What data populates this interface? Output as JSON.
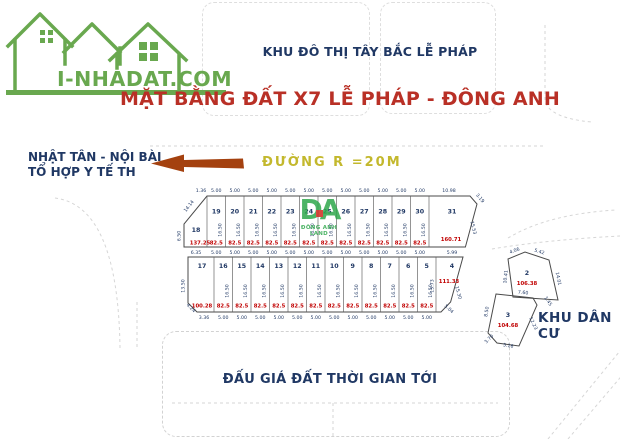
{
  "logo": {
    "text": "I-NHADAT.COM"
  },
  "header": {
    "district": "KHU ĐÔ THỊ TÂY BẮC LỄ PHÁP",
    "title": "MẶT BẰNG ĐẤT X7 LỄ PHÁP - ĐÔNG ANH"
  },
  "annotations": {
    "direction_line1": "NHẬT TÂN - NỘI BÀI",
    "direction_line2": "TỔ HỢP Y TẾ TH",
    "road": "ĐƯỜNG R =20M",
    "residential_area": "KHU DÂN CƯ",
    "auction_note": "ĐẤU GIÁ ĐẤT THỜI GIAN TỚI"
  },
  "watermark": {
    "initials": "DA",
    "name": "ĐÔNG ANH LAND"
  },
  "map": {
    "top_row": {
      "corner_plot": {
        "number": "18",
        "area": "137.25",
        "top_dim": "1.36",
        "left_dim": "6.50",
        "diagonal_dim": "14.14",
        "bottom_dim": "6.35"
      },
      "plots": [
        {
          "number": "19",
          "top_dim": "5.00",
          "height": "16.50",
          "area": "82.5",
          "bottom_dim": "5.00"
        },
        {
          "number": "20",
          "top_dim": "5.00",
          "height": "16.50",
          "area": "82.5",
          "bottom_dim": "5.00"
        },
        {
          "number": "21",
          "top_dim": "5.00",
          "height": "16.50",
          "area": "82.5",
          "bottom_dim": "5.00"
        },
        {
          "number": "22",
          "top_dim": "5.00",
          "height": "16.50",
          "area": "82.5",
          "bottom_dim": "5.00"
        },
        {
          "number": "23",
          "top_dim": "5.00",
          "height": "16.50",
          "area": "82.5",
          "bottom_dim": "5.00"
        },
        {
          "number": "24",
          "top_dim": "5.00",
          "height": "16.50",
          "area": "82.5",
          "bottom_dim": "5.00"
        },
        {
          "number": "25",
          "top_dim": "5.00",
          "height": "16.50",
          "area": "82.5",
          "bottom_dim": "5.00"
        },
        {
          "number": "26",
          "top_dim": "5.00",
          "height": "16.50",
          "area": "82.5",
          "bottom_dim": "5.00"
        },
        {
          "number": "27",
          "top_dim": "5.00",
          "height": "16.50",
          "area": "82.5",
          "bottom_dim": "5.00"
        },
        {
          "number": "28",
          "top_dim": "5.00",
          "height": "16.50",
          "area": "82.5",
          "bottom_dim": "5.00"
        },
        {
          "number": "29",
          "top_dim": "5.00",
          "height": "16.50",
          "area": "82.5",
          "bottom_dim": "5.00"
        },
        {
          "number": "30",
          "top_dim": "5.00",
          "height": "16.50",
          "area": "82.5",
          "bottom_dim": "5.00"
        }
      ],
      "end_plot": {
        "number": "31",
        "area": "160.71",
        "top_dim": "10.98",
        "corner_dim": "3.19",
        "right_dim": "15.53",
        "bottom_dim": "5.99"
      }
    },
    "bottom_row": {
      "corner_plot": {
        "number": "17",
        "area": "100.28",
        "left_dim": "13.50",
        "corner_dim": "4.24",
        "bottom_dim": "3.36"
      },
      "plots": [
        {
          "number": "16",
          "height": "16.50",
          "area": "82.5",
          "bottom_dim": "5.00"
        },
        {
          "number": "15",
          "height": "16.50",
          "area": "82.5",
          "bottom_dim": "5.00"
        },
        {
          "number": "14",
          "height": "16.50",
          "area": "82.5",
          "bottom_dim": "5.00"
        },
        {
          "number": "13",
          "height": "16.50",
          "area": "82.5",
          "bottom_dim": "5.00"
        },
        {
          "number": "12",
          "height": "16.50",
          "area": "82.5",
          "bottom_dim": "5.00"
        },
        {
          "number": "11",
          "height": "16.50",
          "area": "82.5",
          "bottom_dim": "5.00"
        },
        {
          "number": "10",
          "height": "16.50",
          "area": "82.5",
          "bottom_dim": "5.00"
        },
        {
          "number": "9",
          "height": "16.50",
          "area": "82.5",
          "bottom_dim": "5.00"
        },
        {
          "number": "8",
          "height": "16.50",
          "area": "82.5",
          "bottom_dim": "5.00"
        },
        {
          "number": "7",
          "height": "16.50",
          "area": "82.5",
          "bottom_dim": "5.00"
        },
        {
          "number": "6",
          "height": "16.50",
          "area": "82.5",
          "bottom_dim": "5.00"
        },
        {
          "number": "5",
          "height": "16.50",
          "area": "82.5",
          "bottom_dim": "5.00"
        }
      ],
      "end_plot": {
        "number": "4",
        "area": "111.33",
        "left_dim": "15.73",
        "right_dim": "15.30",
        "corner_dim": "5.04"
      }
    },
    "detached_plots": [
      {
        "number": "2",
        "area": "106.38",
        "dims": {
          "top_left": "4.06",
          "top_right": "5.42",
          "left": "10.41",
          "right": "14.01",
          "bottom": "7.60",
          "bottom_right": "1.45"
        }
      },
      {
        "number": "3",
        "area": "104.68",
        "dims": {
          "left": "8.50",
          "bottom_left": "3.70",
          "bottom": "5.16",
          "right": "12.23"
        }
      }
    ]
  }
}
